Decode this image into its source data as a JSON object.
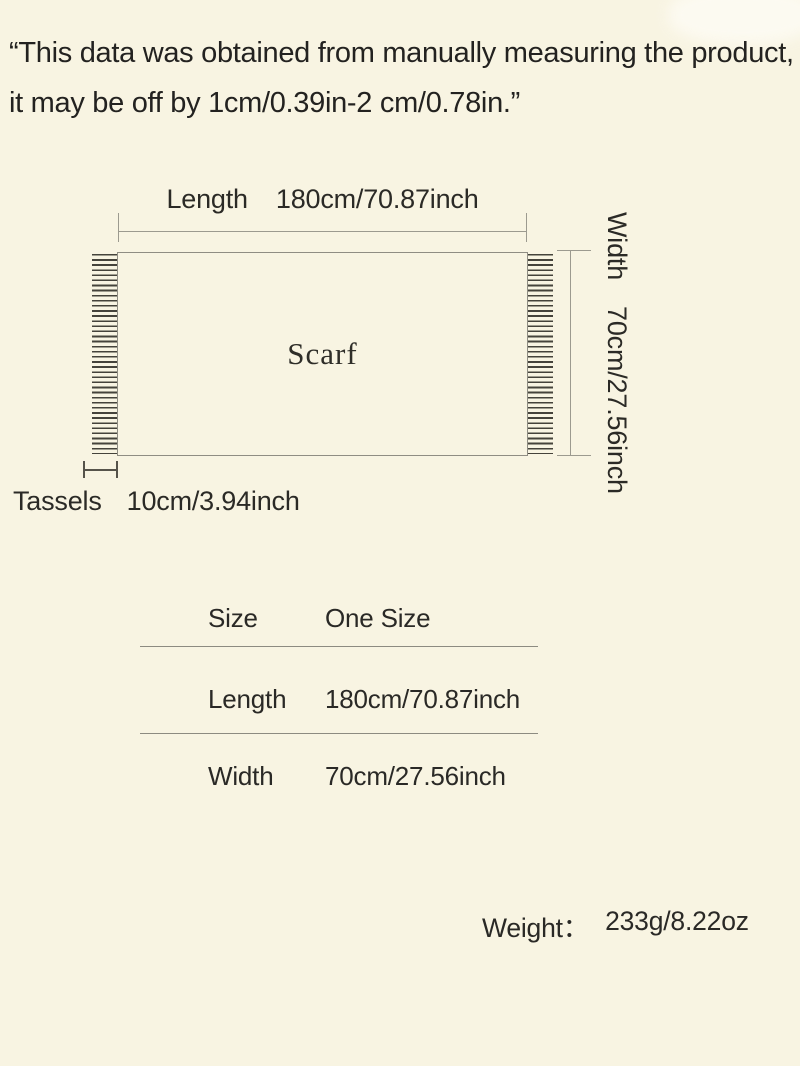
{
  "page": {
    "background_color": "#f8f4e2",
    "text_color": "#2a2925"
  },
  "disclaimer": {
    "lines": [
      "“This data was obtained from manually measuring the product,",
      "it may be off by 1cm/0.39in-2 cm/0.78in.”"
    ]
  },
  "diagram": {
    "product_label": "Scarf",
    "length": {
      "label": "Length",
      "value": "180cm/70.87inch"
    },
    "width": {
      "label": "Width",
      "value": "70cm/27.56inch"
    },
    "tassels": {
      "label": "Tassels",
      "value": "10cm/3.94inch"
    }
  },
  "size_table": {
    "rows": [
      {
        "label": "Size",
        "value": "One Size"
      },
      {
        "label": "Length",
        "value": "180cm/70.87inch"
      },
      {
        "label": "Width",
        "value": "70cm/27.56inch"
      }
    ]
  },
  "weight": {
    "label": "Weight：",
    "value": "233g/8.22oz"
  },
  "colors": {
    "dimension_line": "#9c9a8f",
    "tassel_line": "#45433b",
    "rect_border": "#8f8d83"
  }
}
